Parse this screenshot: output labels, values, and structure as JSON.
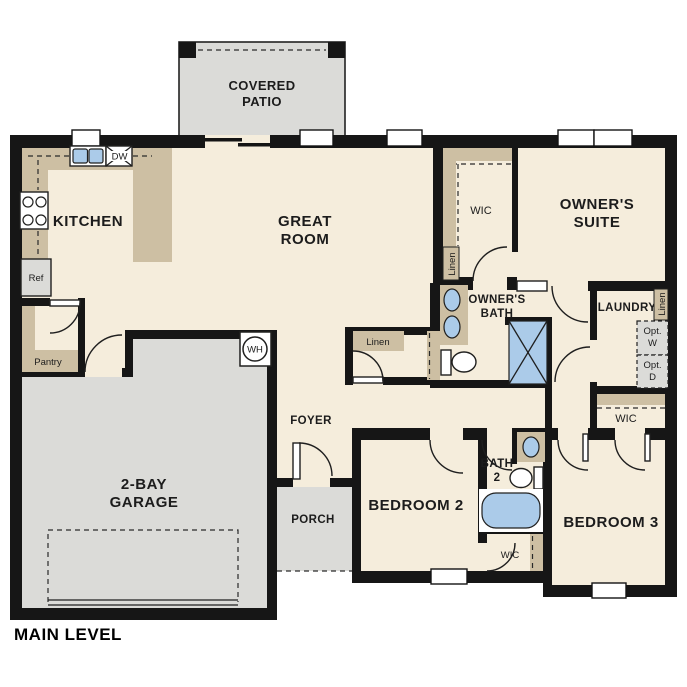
{
  "colors": {
    "floor": "#f5eddc",
    "hard": "#dbdbd8",
    "counter": "#cdbfa3",
    "fixture": "#abcbe9",
    "wall": "#161616",
    "text": "#1c1c1c"
  },
  "title": "MAIN LEVEL",
  "rooms": {
    "covered_patio": [
      "COVERED",
      "PATIO"
    ],
    "kitchen": "KITCHEN",
    "great_room": [
      "GREAT",
      "ROOM"
    ],
    "owners_suite": [
      "OWNER'S",
      "SUITE"
    ],
    "owners_bath": [
      "OWNER'S",
      "BATH"
    ],
    "wic_owners": "WIC",
    "laundry": "LAUNDRY",
    "wic_hall": "WIC",
    "foyer": "FOYER",
    "porch": "PORCH",
    "garage": [
      "2-BAY",
      "GARAGE"
    ],
    "bedroom2": "BEDROOM 2",
    "bedroom3": "BEDROOM 3",
    "bath2": [
      "BATH",
      "2"
    ],
    "wic_bed2": "WIC"
  },
  "closets": {
    "linen_hall": "Linen",
    "linen_wic": "Linen",
    "linen_laundry": "Linen",
    "pantry": "Pantry"
  },
  "appliances": {
    "ref": "Ref",
    "dw": "DW",
    "wh": "WH",
    "opt_w": [
      "Opt.",
      "W"
    ],
    "opt_d": [
      "Opt.",
      "D"
    ]
  }
}
